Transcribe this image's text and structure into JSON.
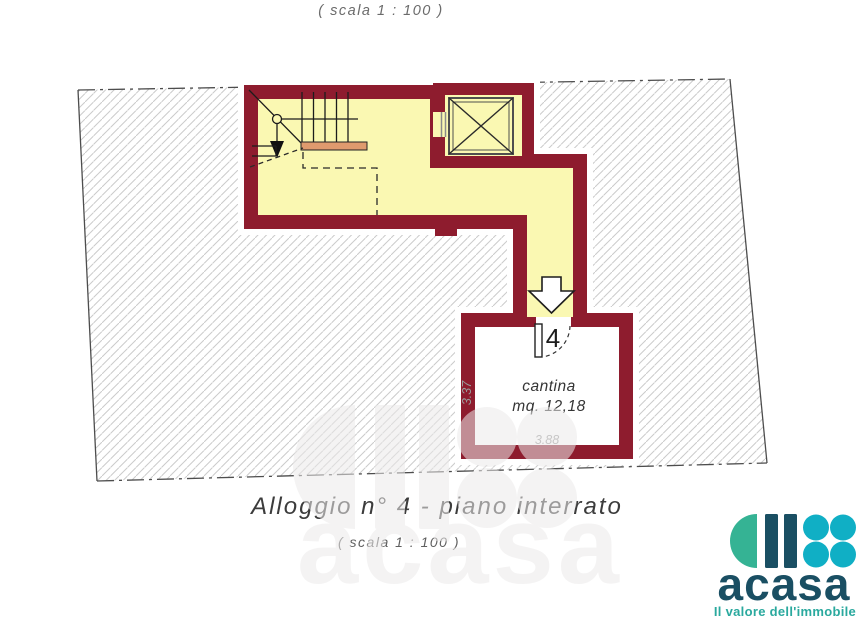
{
  "colors": {
    "maroon": "#8E1C2E",
    "yellow": "#FAF8B2",
    "landing": "#DF9A6E",
    "hatch": "#CBCBCB",
    "boundary": "#4D4D4D",
    "text-dark": "#3C3C3C",
    "text-gray": "#6B6B6B",
    "dim-gray": "#9B9B9B",
    "logo-navy": "#1A4F63",
    "logo-teal": "#35B394",
    "logo-cyan": "#10AFC5",
    "logo-tagline": "#2AA99E",
    "watermark": "#ECEAEA"
  },
  "header": {
    "scale_note": "( scala  1 : 100 )"
  },
  "caption": {
    "title": "Alloggio  n° 4 -  piano interrato",
    "scale_note": "( scala  1 : 100 )"
  },
  "plan": {
    "door_number": "4",
    "room": {
      "name": "cantina",
      "area": "mq. 12,18"
    },
    "dimensions": {
      "width": "3.88",
      "depth": "3.37"
    }
  },
  "watermark": {
    "brand": "acasa"
  },
  "logo": {
    "brand": "acasa",
    "tagline": "Il valore dell'immobile"
  }
}
